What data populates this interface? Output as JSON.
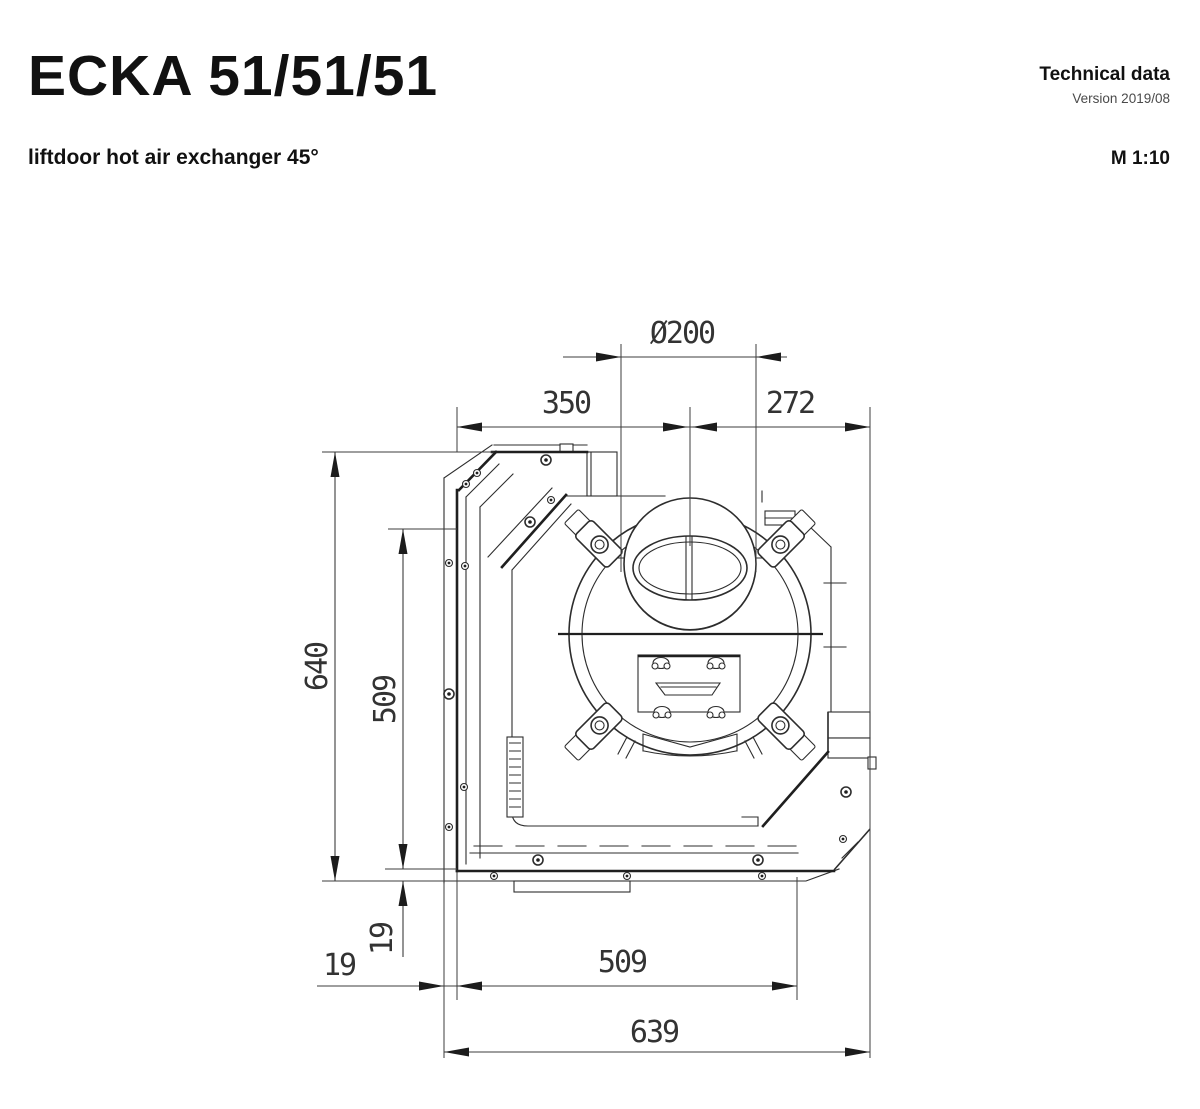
{
  "header": {
    "model": "ECKA 51/51/51",
    "subtitle": "liftdoor hot air exchanger 45°",
    "doc_type": "Technical data",
    "version": "Version 2019/08",
    "scale": "M 1:10"
  },
  "drawing": {
    "view": "plan view of corner hot air exchanger with 45° liftdoor",
    "dimensions": {
      "collar_diameter": "Ø200",
      "width_left_segment": "350",
      "width_right_segment": "272",
      "depth_overall": "640",
      "depth_inner": "509",
      "wall_thickness_left": "19",
      "wall_thickness_bottom": "19",
      "width_inner": "509",
      "width_overall": "639"
    }
  }
}
